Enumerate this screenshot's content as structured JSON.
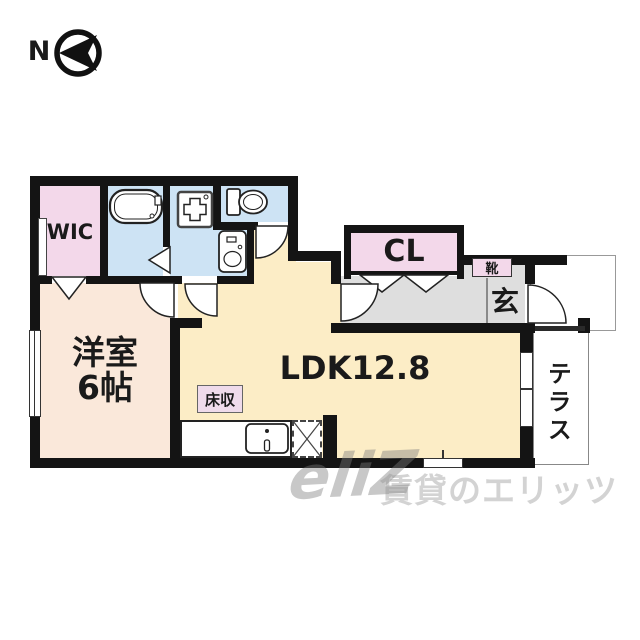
{
  "compass": {
    "label": "N"
  },
  "rooms": {
    "wic": {
      "label": "WIC",
      "color": "#f3d8ea"
    },
    "bathroom": {
      "color": "#cde3f4"
    },
    "washroom": {
      "color": "#cde3f4"
    },
    "toilet": {
      "color": "#cde3f4"
    },
    "western_room": {
      "label": "洋室",
      "size": "6帖",
      "color": "#fae8da"
    },
    "ldk": {
      "label": "LDK12.8",
      "color": "#fcedc6"
    },
    "closet": {
      "label": "CL",
      "color": "#f3d8ea"
    },
    "shoe_cabinet": {
      "label": "靴",
      "color": "#f3d8ea"
    },
    "entrance": {
      "label": "玄",
      "color": "#dedede"
    },
    "floor_storage": {
      "label": "床収",
      "color": "#efdbeb"
    },
    "terrace": {
      "label": "テラス",
      "color": "#ffffff"
    }
  },
  "icons": {
    "bathtub": "bathtub-icon",
    "washer_pan": "washing-machine-pan-icon",
    "toilet_bowl": "toilet-icon",
    "washbasin": "washbasin-icon",
    "kitchen_sink": "kitchen-sink-icon",
    "refrigerator": "refrigerator-space-icon",
    "north_arrow": "north-arrow-icon"
  },
  "watermark": {
    "logo": "eliZ",
    "text": "賃貸のエリッツ"
  }
}
